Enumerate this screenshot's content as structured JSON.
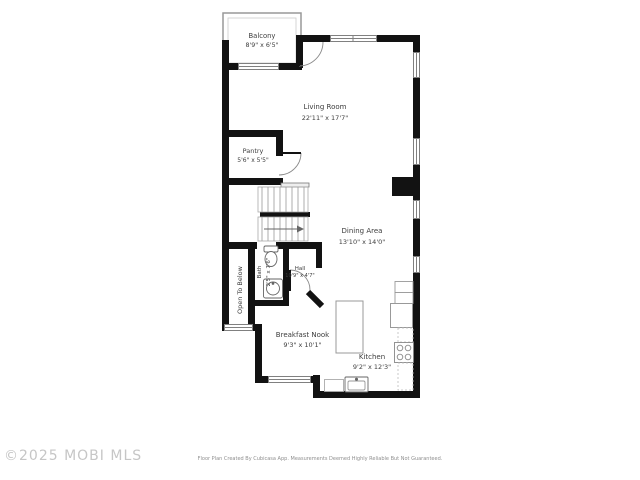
{
  "watermark": "©2025 MOBI MLS",
  "disclaimer": "Floor Plan Created By Cubicasa App. Measurements Deemed Highly Reliable But Not Guaranteed.",
  "rooms": {
    "balcony": {
      "name": "Balcony",
      "dims": "8'9\" x 6'5\""
    },
    "living_room": {
      "name": "Living Room",
      "dims": "22'11\" x 17'7\""
    },
    "pantry": {
      "name": "Pantry",
      "dims": "5'6\" x 5'5\""
    },
    "dining_area": {
      "name": "Dining Area",
      "dims": "13'10\" x 14'0\""
    },
    "bath": {
      "name": "Bath",
      "dims": "2'5\" x 7'6\""
    },
    "hall": {
      "name": "Hall",
      "dims": "10'9\" x 4'7\""
    },
    "breakfast_nook": {
      "name": "Breakfast Nook",
      "dims": "9'3\" x 10'1\""
    },
    "kitchen": {
      "name": "Kitchen",
      "dims": "9'2\" x 12'3\""
    },
    "open_to_below": {
      "name": "Open To Below"
    }
  },
  "colors": {
    "wall": "#121212",
    "fixture_outline": "#8a8a8a",
    "label_text": "#3d3d3d",
    "watermark": "#c6c6c6",
    "disclaimer": "#8f8f8f",
    "background": "#ffffff"
  }
}
